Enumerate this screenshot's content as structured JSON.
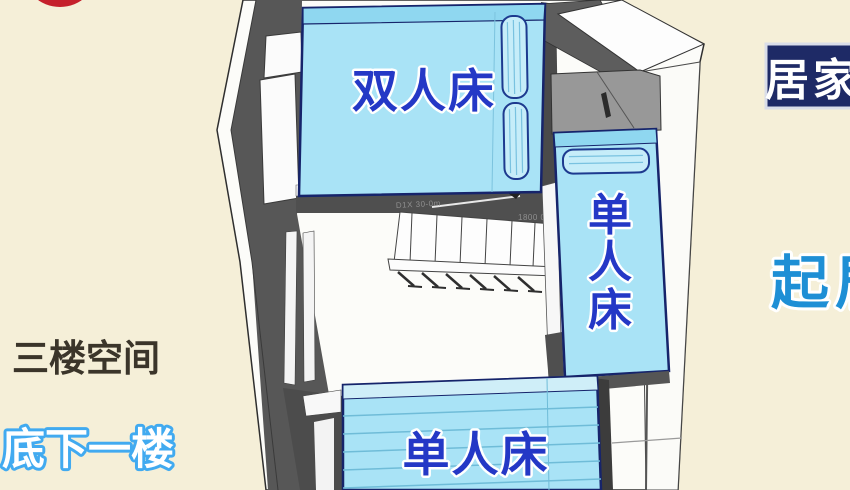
{
  "overlay": {
    "floor_label": "三楼空间",
    "lower_floor_label": "底下一楼",
    "corner_badge": "居家",
    "room_label": "起居"
  },
  "plan": {
    "double_bed_label": "双人床",
    "right_single_bed_chars": [
      "单",
      "人",
      "床"
    ],
    "bottom_single_bed_label": "单人床",
    "stair_annotation_left": "D1X 30-0m",
    "stair_annotation_right": "1800 08"
  },
  "colors": {
    "background": "#f5efd8",
    "marker_red": "#c5202c",
    "bed_fill": "#a9e3f6",
    "bed_band": "#8fd7f0",
    "pillow_fill": "#c6edf9",
    "bed_outline": "#16246b",
    "bed_text": "#2438c6",
    "wall_dark": "#575757",
    "cabinet_gray": "#989898",
    "badge_bg": "#1e2a66",
    "badge_text": "#ffffff",
    "room_label_blue": "#1e8fd5",
    "lower_label_outline": "#41aaf0",
    "floor_label_color": "#3b352a"
  }
}
